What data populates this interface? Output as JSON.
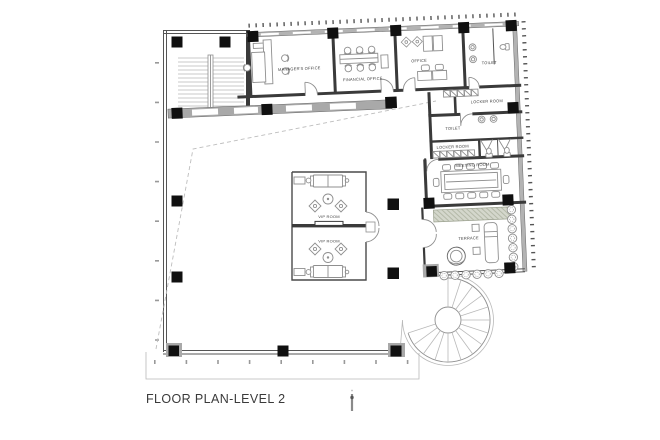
{
  "title": "FLOOR PLAN-LEVEL 2",
  "rooms": {
    "manager_office": "MANAGER'S OFFICE",
    "financial_office": "FINANCIAL OFFICE",
    "office": "OFFICE",
    "toilet_upper": "TOILET",
    "locker_room_upper": "LOCKER ROOM",
    "toilet_lower": "TOILET",
    "locker_room_lower": "LOCKER ROOM",
    "meeting_room": "MEETING ROOM",
    "vip_room_upper": "VIP ROOM",
    "vip_room_lower": "VIP ROOM",
    "terrace": "TERRACE"
  },
  "colors": {
    "wall_dark": "#3a3a3a",
    "wall_gray": "#a9a9a9",
    "window_band": "#b3b3b3",
    "furniture_line": "#8f8f8f",
    "hatch_green": "#aab09c",
    "column_black": "#101010",
    "text": "#3f3f3f"
  }
}
